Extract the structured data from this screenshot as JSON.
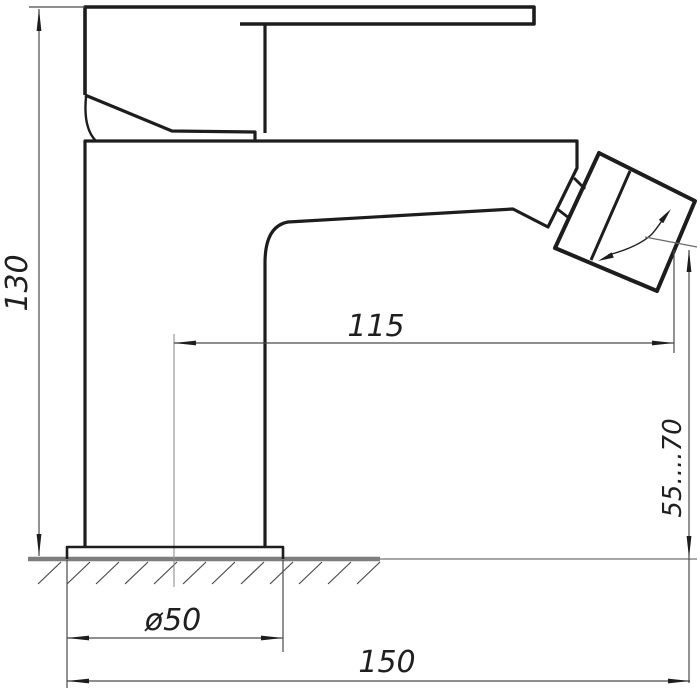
{
  "drawing": {
    "background": "#ffffff",
    "outline_color": "#1d1d1d",
    "dimension_line_color": "#4a4a4a",
    "arrow_color": "#1d1d1d",
    "ground_color": "#7e7e7e",
    "centerline_color": "#8f8f8f",
    "dimensions": {
      "total_height": {
        "label": "130",
        "orientation": "vertical",
        "side": "left"
      },
      "spout_reach": {
        "label": "115",
        "orientation": "horizontal",
        "side": "middle"
      },
      "outlet_height": {
        "label": "55....70",
        "orientation": "vertical",
        "side": "right"
      },
      "base_diameter": {
        "label": "ø50",
        "orientation": "horizontal",
        "side": "bottom"
      },
      "overall_length": {
        "label": "150",
        "orientation": "horizontal",
        "side": "bottom"
      }
    }
  }
}
